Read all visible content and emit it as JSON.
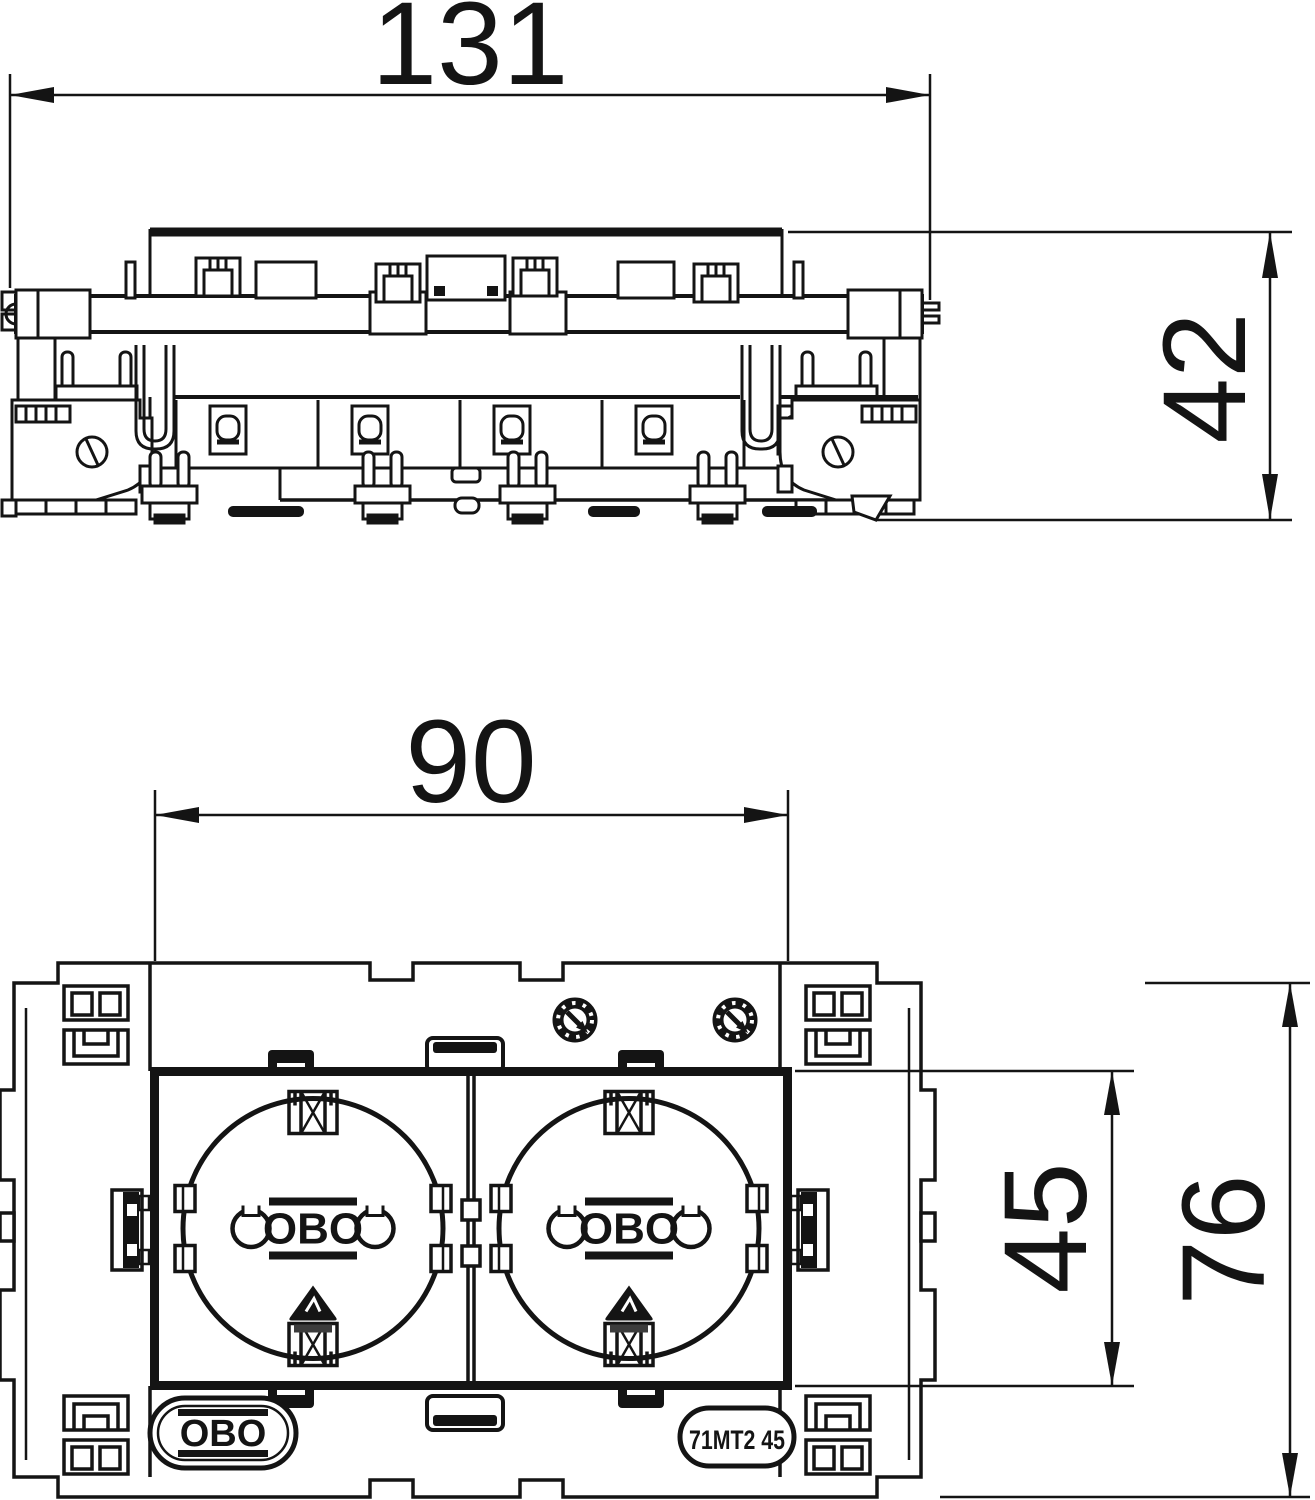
{
  "drawing": {
    "views": {
      "side": {
        "width_mm": "131",
        "height_mm": "42"
      },
      "front": {
        "module_width_mm": "90",
        "module_height_mm": "45",
        "plate_height_mm": "76"
      }
    },
    "branding": {
      "socket_logo": "OBO",
      "plate_logo": "OBO",
      "product_code": "71MT2 45"
    },
    "colors": {
      "line": "#141414",
      "background": "#ffffff"
    }
  }
}
